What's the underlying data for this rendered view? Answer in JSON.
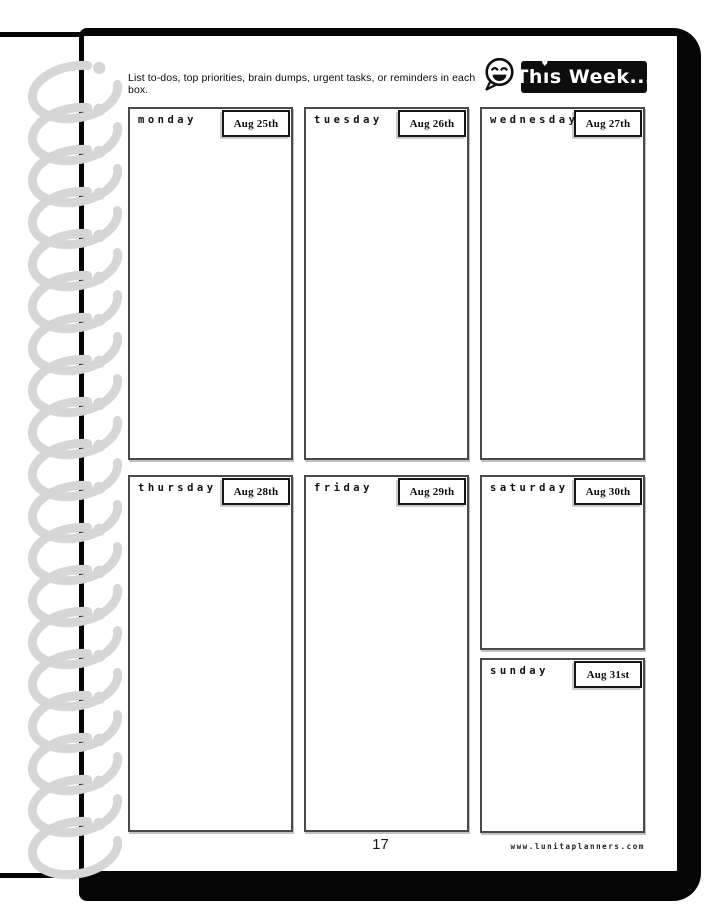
{
  "header": {
    "instruction": "List to-dos, top priorities, brain dumps, urgent tasks, or reminders in each box.",
    "badge": {
      "label": "This Week...",
      "pre": "Th",
      "i_char": "ı",
      "heart": "♥",
      "post": "s Week..."
    },
    "icon": "smiley-speech-bubble",
    "accent_color": "#0d0d0d"
  },
  "days": [
    {
      "name": "monday",
      "date": "Aug 25th"
    },
    {
      "name": "tuesday",
      "date": "Aug 26th"
    },
    {
      "name": "wednesday",
      "date": "Aug 27th"
    },
    {
      "name": "thursday",
      "date": "Aug 28th"
    },
    {
      "name": "friday",
      "date": "Aug 29th"
    },
    {
      "name": "saturday",
      "date": "Aug 30th"
    },
    {
      "name": "sunday",
      "date": "Aug 31st"
    }
  ],
  "footer": {
    "page_number": "17",
    "website": "www.lunitaplanners.com"
  },
  "colors": {
    "cover_black": "#050505",
    "coil_gray": "#d6d6d6",
    "box_border": "#4a4a4a"
  }
}
